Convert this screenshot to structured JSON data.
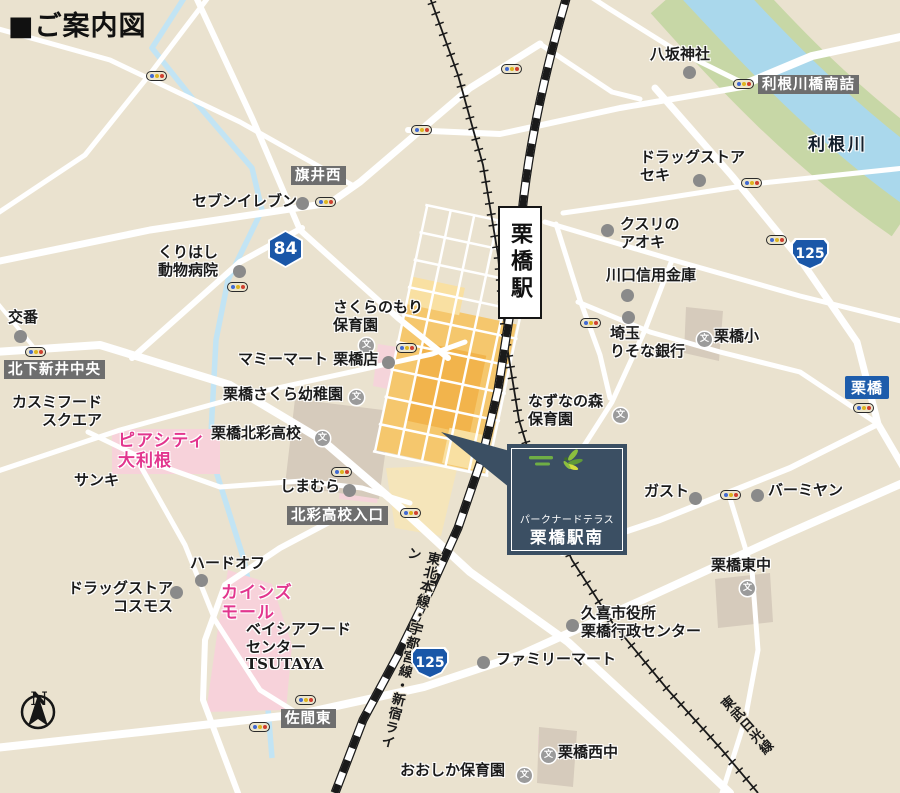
{
  "title": "■ご案内図",
  "compass": {
    "label": "N"
  },
  "station": {
    "name": "栗橋駅"
  },
  "property": {
    "line1": "パークナードテラス",
    "line2": "栗橋駅南"
  },
  "railways": {
    "jr_label": "東北本線・宇都宮線・新宿ライン",
    "tobu_label": "東武日光線"
  },
  "road_sign": {
    "label": "栗橋"
  },
  "school_icon_glyph": "文",
  "colors": {
    "land": "#eae2cf",
    "road": "#ffffff",
    "river": "#aad8ec",
    "riverbank": "#c7d7a6",
    "district_orange": "#f5c76d",
    "district_orange_dark": "#f2b44c",
    "district_orange_light": "#f9e0a2",
    "pink_area": "#f7d2da",
    "magenta_text": "#e2368e",
    "gray_label_bg": "#6e6e6e",
    "sign_blue": "#1d5cab",
    "badge_blue": "#1a57a8",
    "property_navy": "#3b4f63",
    "rail_black": "#1a1a1a",
    "building_taupe": "#d6cbbc"
  },
  "route_badges": [
    {
      "number": "84",
      "shape": "hexagon",
      "x": 268,
      "y": 230
    },
    {
      "number": "125",
      "shape": "shield",
      "x": 791,
      "y": 238
    },
    {
      "number": "125",
      "shape": "shield",
      "x": 411,
      "y": 647
    }
  ],
  "intersections": [
    {
      "id": "tonegawabashi-minamizume",
      "label": "利根川橋南詰",
      "x": 758,
      "y": 75
    },
    {
      "id": "hatai-nishi",
      "label": "旗井西",
      "x": 291,
      "y": 166
    },
    {
      "id": "kitashimoarai-chuo",
      "label": "北下新井中央",
      "x": 4,
      "y": 360
    },
    {
      "id": "hokusai-koko-iriguchi",
      "label": "北彩高校入口",
      "x": 287,
      "y": 506
    },
    {
      "id": "sama-higashi",
      "label": "佐間東",
      "x": 281,
      "y": 709
    }
  ],
  "labels": [
    {
      "id": "seven-eleven",
      "text": "セブンイレブン",
      "x": 192,
      "y": 193,
      "marker": "dot",
      "mx": 296,
      "my": 197
    },
    {
      "id": "kurihashi-animal-hospital",
      "text": "くりはし\n動物病院",
      "x": 158,
      "y": 244,
      "marker": "dot",
      "mx": 233,
      "my": 265
    },
    {
      "id": "koban",
      "text": "交番",
      "x": 8,
      "y": 309,
      "marker": "dot",
      "mx": 14,
      "my": 330
    },
    {
      "id": "yasaka-shrine",
      "text": "八坂神社",
      "x": 650,
      "y": 46,
      "marker": "dot",
      "mx": 683,
      "my": 66
    },
    {
      "id": "drugstore-seki",
      "text": "ドラッグストア\nセキ",
      "x": 640,
      "y": 149,
      "marker": "dot",
      "mx": 693,
      "my": 174
    },
    {
      "id": "kusuri-no-aoki",
      "text": "クスリの\nアオキ",
      "x": 620,
      "y": 216,
      "marker": "dot",
      "mx": 601,
      "my": 224
    },
    {
      "id": "kawaguchi-shinkin-bank",
      "text": "川口信用金庫",
      "x": 606,
      "y": 267,
      "marker": "dot",
      "mx": 621,
      "my": 289
    },
    {
      "id": "saitama-resona-bank",
      "text": "埼玉\nりそな銀行",
      "x": 610,
      "y": 325,
      "marker": "dot",
      "mx": 622,
      "my": 311
    },
    {
      "id": "mami-mart-kurihashi",
      "text": "マミーマート 栗橋店",
      "x": 238,
      "y": 351,
      "marker": "dot",
      "mx": 382,
      "my": 356
    },
    {
      "id": "shimamura",
      "text": "しまむら",
      "x": 280,
      "y": 478,
      "marker": "dot",
      "mx": 343,
      "my": 484
    },
    {
      "id": "hard-off",
      "text": "ハードオフ",
      "x": 190,
      "y": 555,
      "marker": "dot",
      "mx": 195,
      "my": 574
    },
    {
      "id": "drugstore-cosmos",
      "text": "ドラッグストア\nコスモス",
      "x": 68,
      "y": 580,
      "align": "right",
      "marker": "dot",
      "mx": 170,
      "my": 586
    },
    {
      "id": "gusto",
      "text": "ガスト",
      "x": 644,
      "y": 483,
      "marker": "dot",
      "mx": 689,
      "my": 492
    },
    {
      "id": "bamiyan",
      "text": "バーミヤン",
      "x": 768,
      "y": 482,
      "marker": "dot",
      "mx": 751,
      "my": 489
    },
    {
      "id": "kuki-city-office",
      "text": "久喜市役所\n栗橋行政センター",
      "x": 581,
      "y": 605,
      "marker": "dot",
      "mx": 566,
      "my": 619
    },
    {
      "id": "family-mart",
      "text": "ファミリーマート",
      "x": 496,
      "y": 651,
      "marker": "dot",
      "mx": 477,
      "my": 656
    },
    {
      "id": "sanki",
      "text": "サンキ",
      "x": 74,
      "y": 472
    },
    {
      "id": "kasumi-food-square",
      "text": "カスミフード\nスクエア",
      "x": 12,
      "y": 394,
      "align": "right"
    },
    {
      "id": "tone-river",
      "text": "利根川",
      "x": 808,
      "y": 135,
      "class": "river-label"
    },
    {
      "id": "beisia-food-center-tsutaya",
      "text": "ベイシアフード\nセンター\nTSUTAYA",
      "x": 246,
      "y": 621
    },
    {
      "id": "piacity-otone",
      "text": "ピアシティ\n大利根",
      "x": 118,
      "y": 431,
      "class": "magenta"
    },
    {
      "id": "cainz-mall",
      "text": "カインズ\nモール",
      "x": 221,
      "y": 583,
      "class": "magenta"
    },
    {
      "id": "sakuranomori-nursery",
      "text": "さくらのもり\n保育園",
      "x": 333,
      "y": 299,
      "marker": "school",
      "mx": 359,
      "my": 338
    },
    {
      "id": "kurihashi-sakura-kindergarten",
      "text": "栗橋さくら幼稚園",
      "x": 223,
      "y": 386,
      "marker": "school",
      "mx": 349,
      "my": 390
    },
    {
      "id": "kurihashi-hokusai-high-school",
      "text": "栗橋北彩高校",
      "x": 211,
      "y": 425,
      "marker": "school",
      "mx": 315,
      "my": 431
    },
    {
      "id": "kurihashi-elementary",
      "text": "栗橋小",
      "x": 714,
      "y": 328,
      "marker": "school",
      "mx": 697,
      "my": 332
    },
    {
      "id": "nazuna-no-mori-nursery",
      "text": "なずなの森\n保育園",
      "x": 528,
      "y": 393,
      "marker": "school",
      "mx": 613,
      "my": 408
    },
    {
      "id": "kurihashi-higashi-jhs",
      "text": "栗橋東中",
      "x": 711,
      "y": 557,
      "marker": "school",
      "mx": 740,
      "my": 581
    },
    {
      "id": "kurihashi-nishi-jhs",
      "text": "栗橋西中",
      "x": 558,
      "y": 744,
      "marker": "school",
      "mx": 541,
      "my": 748
    },
    {
      "id": "ooshika-nursery",
      "text": "おおしか保育園",
      "x": 400,
      "y": 762,
      "marker": "school",
      "mx": 517,
      "my": 768
    }
  ],
  "signals": [
    {
      "x": 146,
      "y": 71
    },
    {
      "x": 501,
      "y": 64
    },
    {
      "x": 411,
      "y": 125
    },
    {
      "x": 733,
      "y": 79
    },
    {
      "x": 741,
      "y": 178
    },
    {
      "x": 315,
      "y": 197
    },
    {
      "x": 227,
      "y": 282
    },
    {
      "x": 580,
      "y": 318
    },
    {
      "x": 853,
      "y": 403
    },
    {
      "x": 720,
      "y": 490
    },
    {
      "x": 25,
      "y": 347
    },
    {
      "x": 396,
      "y": 343
    },
    {
      "x": 331,
      "y": 467
    },
    {
      "x": 400,
      "y": 508
    },
    {
      "x": 295,
      "y": 695
    },
    {
      "x": 249,
      "y": 722
    },
    {
      "x": 766,
      "y": 235
    }
  ]
}
